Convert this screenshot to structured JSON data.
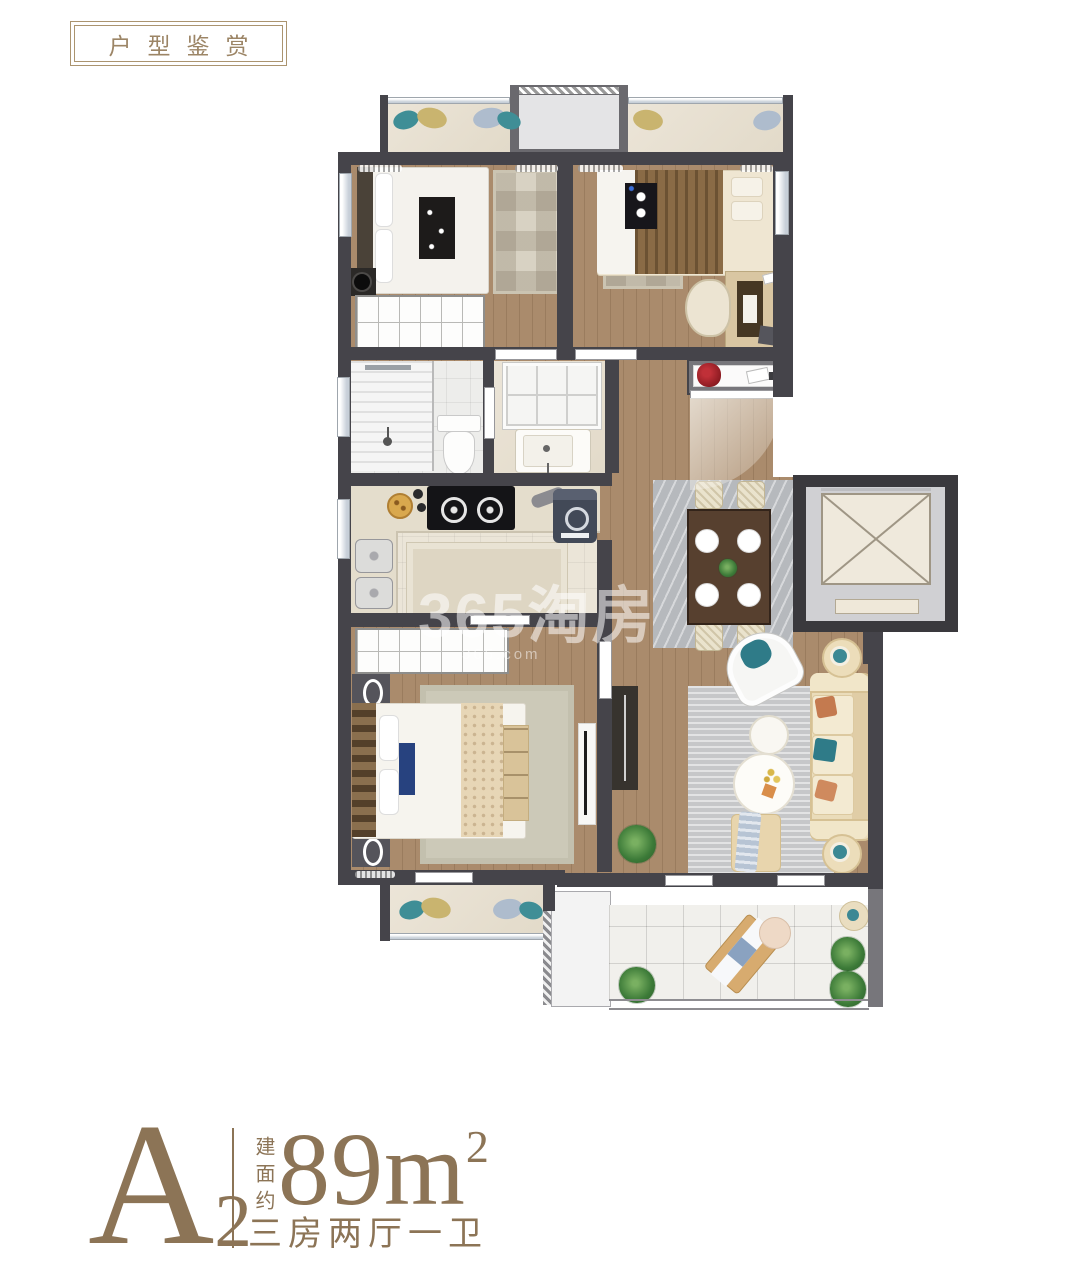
{
  "badge": {
    "text": "户型鉴赏"
  },
  "watermark": {
    "brand": "365淘房",
    "domain": "365.com"
  },
  "unit": {
    "name": "A",
    "subscript": "2",
    "area_label_vertical": "建面约",
    "area_value": "89",
    "area_unit": "m",
    "area_exponent": "2",
    "layout_text": "三房两厅一卫"
  },
  "colors": {
    "accent_gold": "#8c7456",
    "wall_dark": "#45444a",
    "wall_mid": "#77767b",
    "wood_floor": "#aa8b6c",
    "marble_balcony": "#e8e1d3",
    "tile_white": "#f1f0ec",
    "rug_grey": "#b7bac0",
    "sofa_cream": "#eadcba",
    "teal": "#3b8894",
    "stone_gold": "#c9b46f",
    "elevator_fill": "#efe9dc"
  }
}
